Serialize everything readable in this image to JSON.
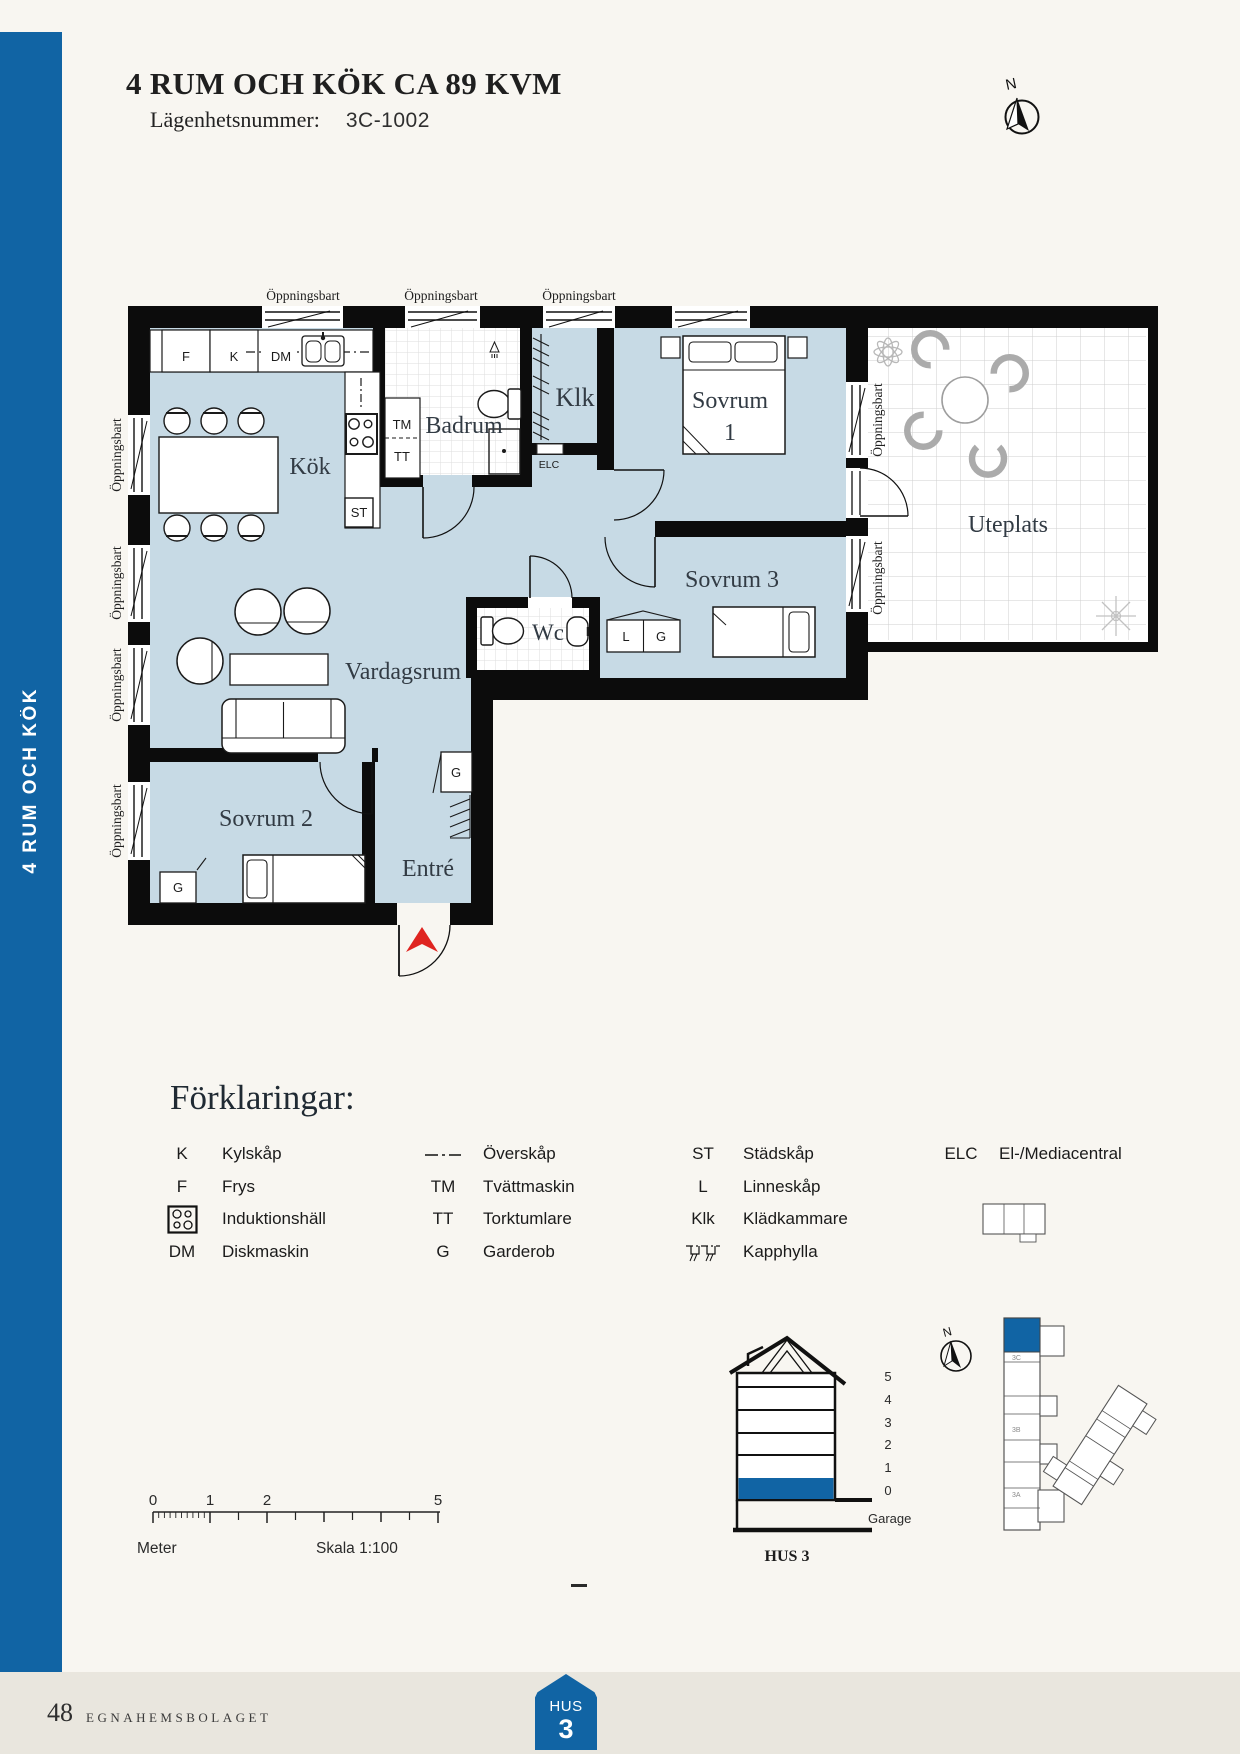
{
  "page": {
    "background": "#f8f6f1",
    "accent_blue": "#1164a4",
    "plan_floor_blue": "#c7dae5",
    "footer_band": "#e9e6de",
    "entrance_arrow_red": "#df2420"
  },
  "sidebar": {
    "vertical_label": "4 RUM OCH KÖK"
  },
  "header": {
    "title": "4 RUM OCH KÖK CA 89 KVM",
    "apartment_number_label": "Lägenhetsnummer:",
    "apartment_number": "3C-1002"
  },
  "compass": {
    "north_label": "N"
  },
  "plan": {
    "window_label": "Öppningsbart",
    "rooms": {
      "kok": "Kök",
      "badrum": "Badrum",
      "klk": "Klk",
      "sovrum1_line1": "Sovrum",
      "sovrum1_line2": "1",
      "sovrum3": "Sovrum 3",
      "uteplats": "Uteplats",
      "vardagsrum": "Vardagsrum",
      "sovrum2": "Sovrum 2",
      "entre": "Entré",
      "wc": "Wc"
    },
    "markers": {
      "f": "F",
      "k": "K",
      "dm": "DM",
      "tm": "TM",
      "tt": "TT",
      "st": "ST",
      "elc": "ELC",
      "l": "L",
      "g": "G"
    }
  },
  "legend": {
    "heading": "Förklaringar:",
    "col1": [
      {
        "sym": "K",
        "label": "Kylskåp"
      },
      {
        "sym": "F",
        "label": "Frys"
      },
      {
        "sym": "",
        "label": "Induktionshäll"
      },
      {
        "sym": "DM",
        "label": "Diskmaskin"
      }
    ],
    "col2": [
      {
        "sym": "",
        "label": "Överskåp"
      },
      {
        "sym": "TM",
        "label": "Tvättmaskin"
      },
      {
        "sym": "TT",
        "label": "Torktumlare"
      },
      {
        "sym": "G",
        "label": "Garderob"
      }
    ],
    "col3": [
      {
        "sym": "ST",
        "label": "Städskåp"
      },
      {
        "sym": "L",
        "label": "Linneskåp"
      },
      {
        "sym": "Klk",
        "label": "Klädkammare"
      },
      {
        "sym": "",
        "label": "Kapphylla"
      }
    ],
    "col4": [
      {
        "sym": "ELC",
        "label": "El-/Mediacentral"
      }
    ]
  },
  "scalebar": {
    "tick0": "0",
    "tick1": "1",
    "tick2": "2",
    "tick5": "5",
    "unit": "Meter",
    "scale": "Skala 1:100"
  },
  "building_section": {
    "floor5": "5",
    "floor4": "4",
    "floor3": "3",
    "floor2": "2",
    "floor1": "1",
    "floor0": "0",
    "garage": "Garage",
    "name": "HUS 3",
    "north_label": "N",
    "site": {
      "c": "3C",
      "b": "3B",
      "a": "3A"
    }
  },
  "footer": {
    "page_number": "48",
    "publisher": "EGNAHEMSBOLAGET",
    "badge_line1": "HUS",
    "badge_line2": "3"
  }
}
